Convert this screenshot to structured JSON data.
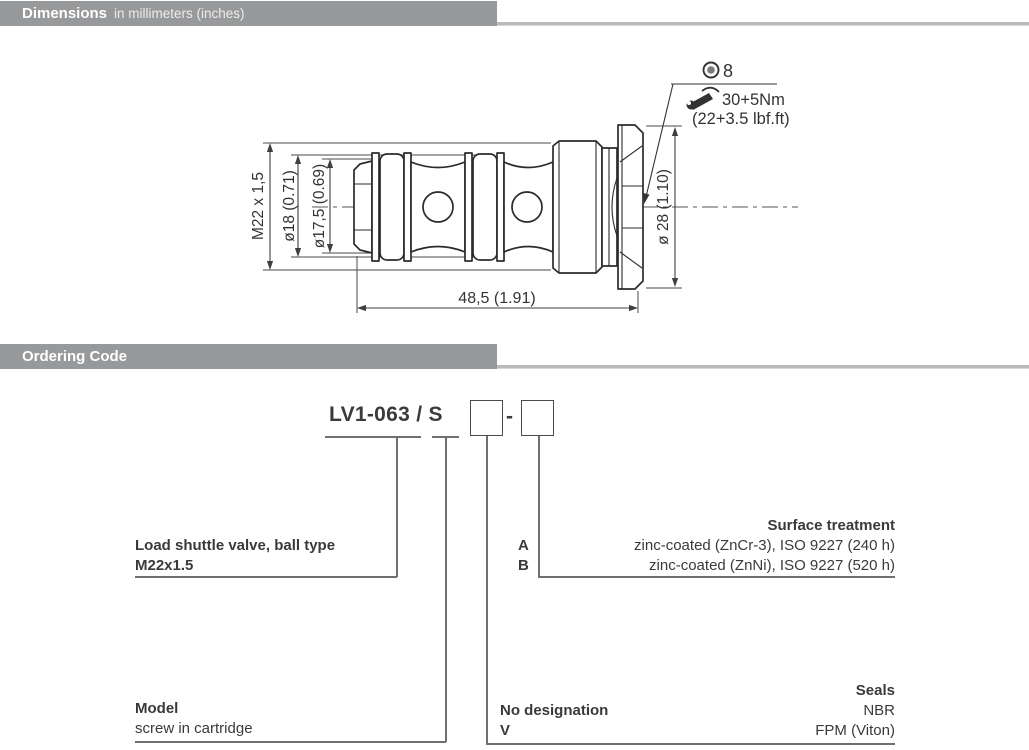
{
  "sections": {
    "dimensions": {
      "title": "Dimensions",
      "subtitle": "in millimeters (inches)"
    },
    "ordering": {
      "title": "Ordering Code"
    }
  },
  "drawing": {
    "labels": {
      "thread": "M22 x 1,5",
      "dia18": "ø18 (0.71)",
      "dia175": "ø17,5 (0.69)",
      "dia28": "ø 28 (1.10)",
      "length": "48,5 (1.91)",
      "hex_size": "8",
      "torque_nm": "30+5Nm",
      "torque_lbft": "(22+3.5 lbf.ft)"
    },
    "icons": {
      "socket": "hex-socket-icon",
      "wrench": "torque-wrench-icon"
    }
  },
  "ordering_code": {
    "base_code": "LV1-063 / S",
    "separator": "-",
    "branches": {
      "type": {
        "line1": "Load shuttle valve, ball type",
        "line2": "M22x1.5"
      },
      "model": {
        "title": "Model",
        "value": "screw in cartridge"
      },
      "surface": {
        "title": "Surface treatment",
        "options": [
          {
            "code": "A",
            "desc": "zinc-coated (ZnCr-3), ISO 9227 (240 h)"
          },
          {
            "code": "B",
            "desc": "zinc-coated (ZnNi), ISO 9227 (520 h)"
          }
        ]
      },
      "seals": {
        "title": "Seals",
        "options": [
          {
            "code": "No designation",
            "desc": "NBR"
          },
          {
            "code": "V",
            "desc": "FPM (Viton)"
          }
        ]
      }
    }
  },
  "colors": {
    "header_bar": "#98999b",
    "header_text": "#ffffff",
    "line_gray": "#6e6f71",
    "drawing_stroke": "#2b2b2b",
    "text": "#3a3a3d"
  }
}
